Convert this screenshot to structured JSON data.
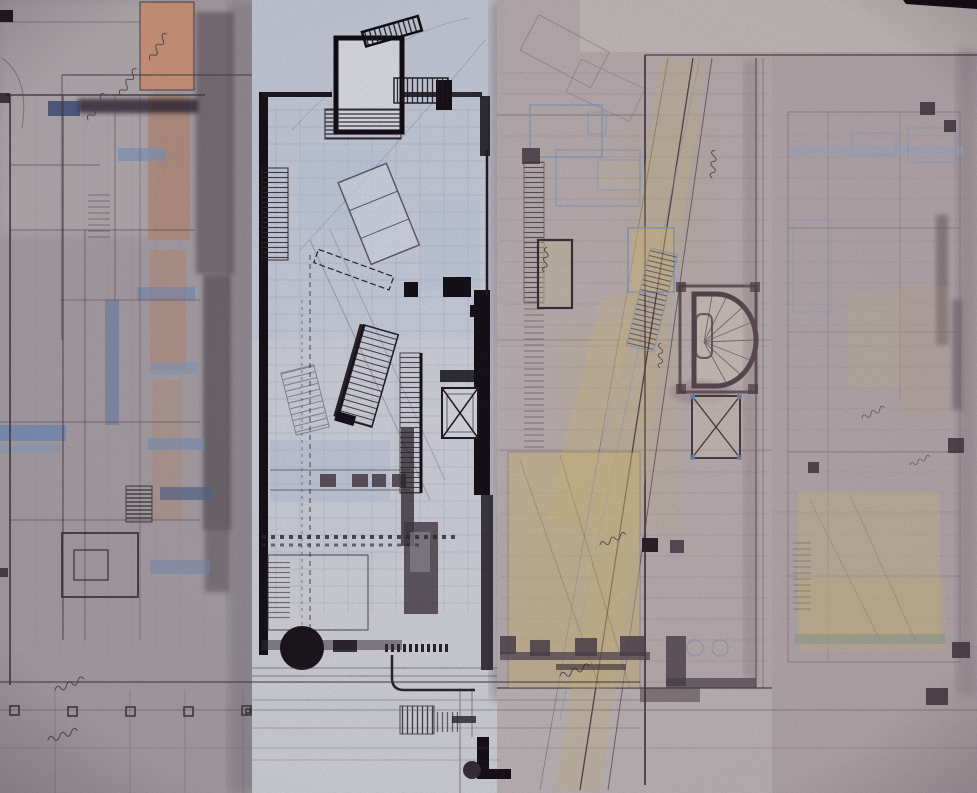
{
  "artwork": {
    "kind": "photograph of overlapping hand-drawn architectural floor plan sheets",
    "visible_text": "",
    "sheets": [
      {
        "id": "left-plan-sheet",
        "paper_color": "#b0a8ae",
        "accents": [
          "#db9d7f",
          "#7b93c0",
          "#4d4049"
        ]
      },
      {
        "id": "center-plan-sheet",
        "paper_color": "#d8dae5",
        "accents": [
          "#18121a",
          "#9aa8cc",
          "#b9c6e2"
        ]
      },
      {
        "id": "right-center-plan-sheet",
        "paper_color": "#c3b7b9",
        "accents": [
          "#d7c084",
          "#5a464e",
          "#8ba1c8"
        ]
      },
      {
        "id": "far-right-plan-sheet",
        "paper_color": "#beb2b6",
        "accents": [
          "#d8c289",
          "#8ea6cc",
          "#473741"
        ]
      }
    ],
    "palette": {
      "ink_black": "#18121a",
      "charcoal": "#463b44",
      "maroon_pencil": "#5a464e",
      "blue_pencil": "#8ba1c8",
      "salmon_wash": "#db9d7f",
      "yellow_wash": "#d7c084",
      "blue_wash": "#7b93c0",
      "teal_wash": "#7fa098"
    }
  }
}
